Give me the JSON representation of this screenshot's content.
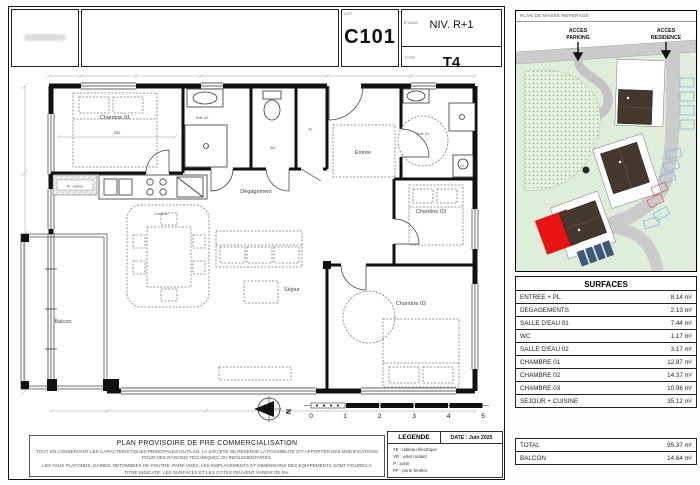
{
  "title_block": {
    "lot_label": "LOT",
    "lot": "C101",
    "etage_label": "ETAGE",
    "etage": "NIV. R+1",
    "type_label": "TYPE",
    "type": "T4"
  },
  "site_plan": {
    "header": "PLAN DE MASSE REPERAGE",
    "acces_parking_line1": "ACCES",
    "acces_parking_line2": "PARKING",
    "acces_residence_line1": "ACCES",
    "acces_residence_line2": "RESIDENCE"
  },
  "surfaces": {
    "header": "SURFACES",
    "rows": [
      {
        "label": "ENTREE + PL.",
        "value": "8.14 m²"
      },
      {
        "label": "DEGAGEMENTS",
        "value": "2.13 m²"
      },
      {
        "label": "SALLE D'EAU 01",
        "value": "7.44 m²"
      },
      {
        "label": "WC",
        "value": "1.17 m²"
      },
      {
        "label": "SALLE D'EAU 02",
        "value": "3.17 m²"
      },
      {
        "label": "CHAMBRE 01",
        "value": "12.87 m²"
      },
      {
        "label": "CHAMBRE 02",
        "value": "14.37 m²"
      },
      {
        "label": "CHAMBRE 03",
        "value": "10.96 m²"
      },
      {
        "label": "SEJOUR + CUISINE",
        "value": "35.12 m²"
      }
    ],
    "total": {
      "label": "TOTAL",
      "value": "95.37 m²"
    },
    "balcon": {
      "label": "BALCON",
      "value": "14.64 m²"
    }
  },
  "floor_plan": {
    "rooms": {
      "chambre01": "Chambre 01",
      "chambre02": "Chambre 02",
      "chambre03": "Chambre 03",
      "sde01": "Sde 01",
      "sde02": "Sde 02",
      "wc": "WC",
      "pl": "Pl.",
      "pl_option": "Pl. option",
      "entree": "Entrée",
      "degagement": "Dégagement",
      "cuisine": "Cuisine",
      "sejour": "Séjour",
      "balcon": "Balcon",
      "ll": "LL"
    },
    "dim_chambre01": "383",
    "north_label": "N",
    "scale_ticks": [
      "0",
      "1",
      "2",
      "3",
      "4",
      "5"
    ]
  },
  "legend": {
    "title": "LEGENDE",
    "date": "DATE : Juin 2025",
    "items": [
      "TE : tableau électrique",
      "VR : volet roulant",
      "P : porte",
      "PF : porte-fenêtre"
    ]
  },
  "disclaimer": {
    "title": "PLAN PROVISOIRE DE PRE COMMERCIALISATION",
    "line1": "TOUT EN CONSERVANT LES CARACTERISTIQUES PRINCIPALES DU PLAN, LA SOCIETE SE RESERVE LA POSSIBILITE D'Y APPORTER DES MODIFICATIONS POUR DES RAISONS TECHNIQUES OU REGLEMENTAIRES.",
    "line2": "LES FAUX PLAFONDS, GAINES, RETOMBEES DE POUTRE, PARE-VUES, LES EMPLACEMENTS ET DIMENSIONS DES EQUIPEMENTS SONT FIGURES A TITRE INDICATIF. LES SURFACES ET LES COTES PEUVENT VARIER DE 5%."
  },
  "colors": {
    "accent_red": "#e81313",
    "site_green": "#dfeeda",
    "road_gray": "#cbcbcb",
    "parking_blue": "#7fb0e0"
  }
}
